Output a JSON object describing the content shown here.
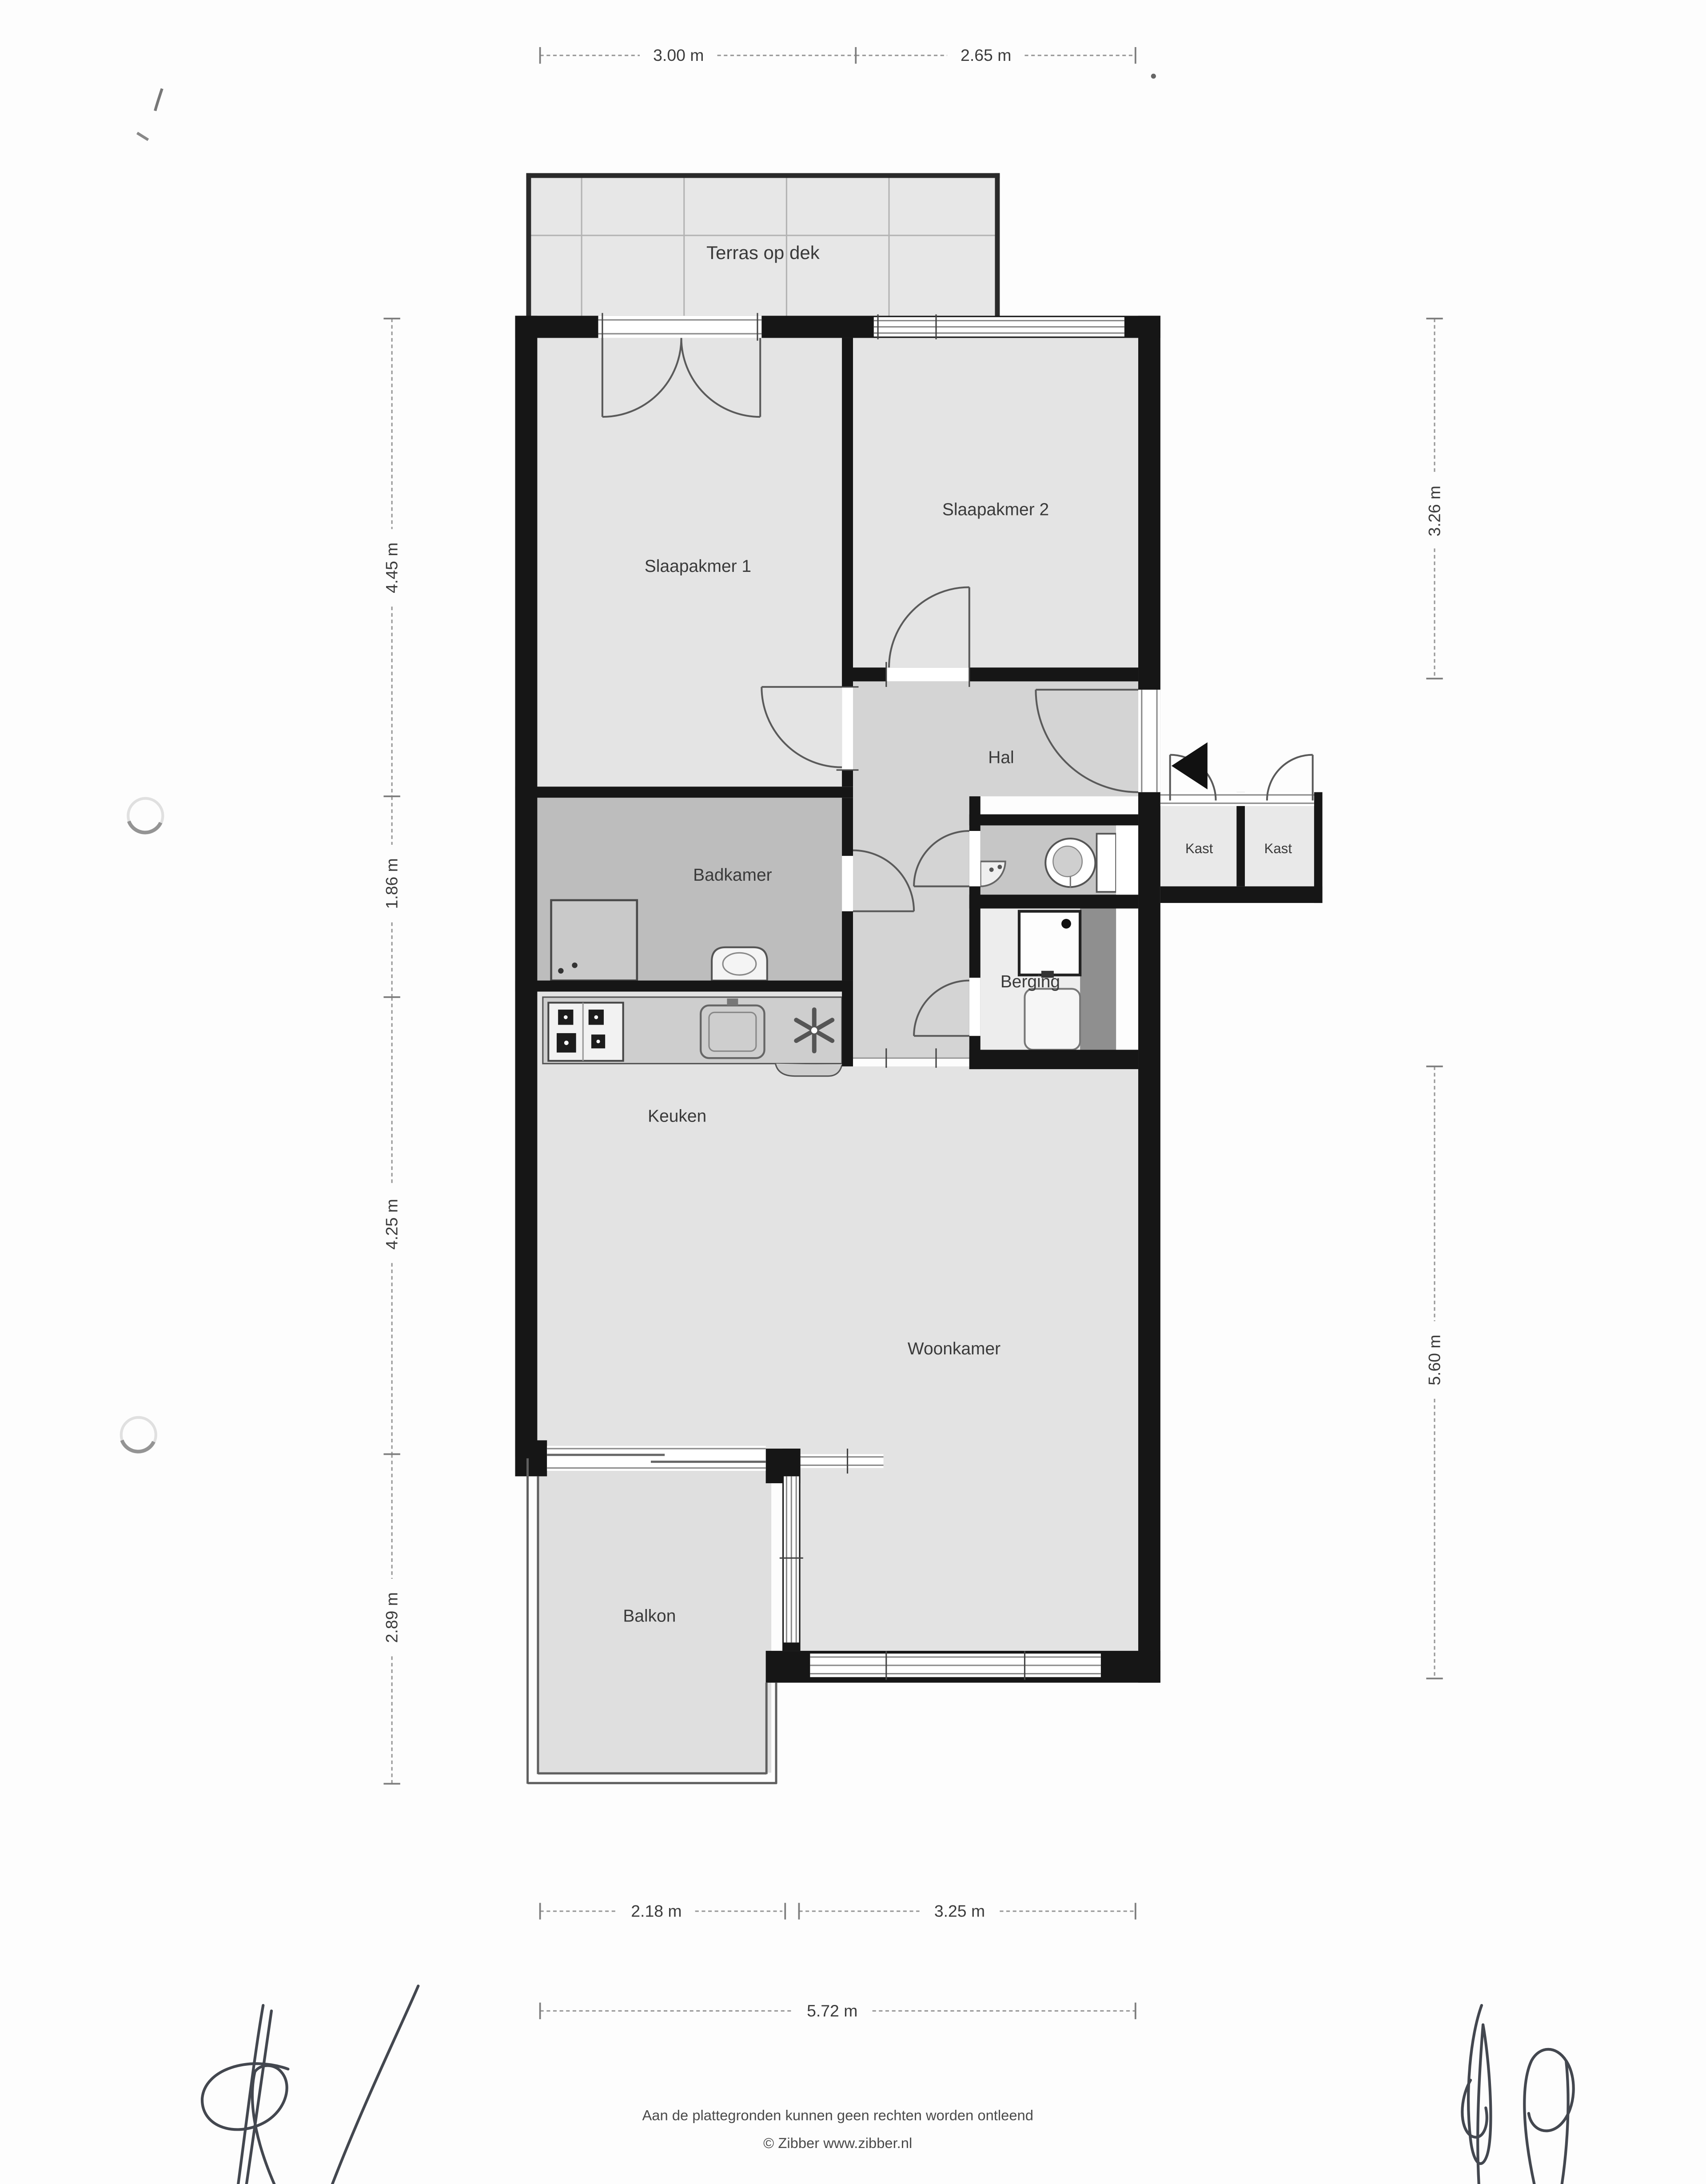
{
  "document": {
    "type": "floorplan-scan",
    "footer": {
      "line1": "Aan de plattegronden kunnen geen rechten worden ontleend",
      "line2": "© Zibber www.zibber.nl"
    }
  },
  "rooms": {
    "terras": "Terras op dek",
    "slaapkamer1": "Slaapakmer 1",
    "slaapkamer2": "Slaapakmer 2",
    "hal": "Hal",
    "badkamer": "Badkamer",
    "kast1": "Kast",
    "kast2": "Kast",
    "berging": "Berging",
    "keuken": "Keuken",
    "woonkamer": "Woonkamer",
    "balkon": "Balkon"
  },
  "dimensions": {
    "top1": "3.00 m",
    "top2": "2.65 m",
    "left1": "4.45 m",
    "left2": "1.86 m",
    "left3": "4.25 m",
    "left4": "2.89 m",
    "right1": "3.26 m",
    "right2": "5.60 m",
    "bottom1": "2.18 m",
    "bottom2": "3.25 m",
    "bottom_total": "5.72 m"
  },
  "colors": {
    "wall": "#161616",
    "room_fill": "#e4e4e4",
    "hall_fill": "#d4d4d4",
    "wet_room_fill": "#bdbdbd",
    "shaft_fill": "#8f8f8f"
  }
}
